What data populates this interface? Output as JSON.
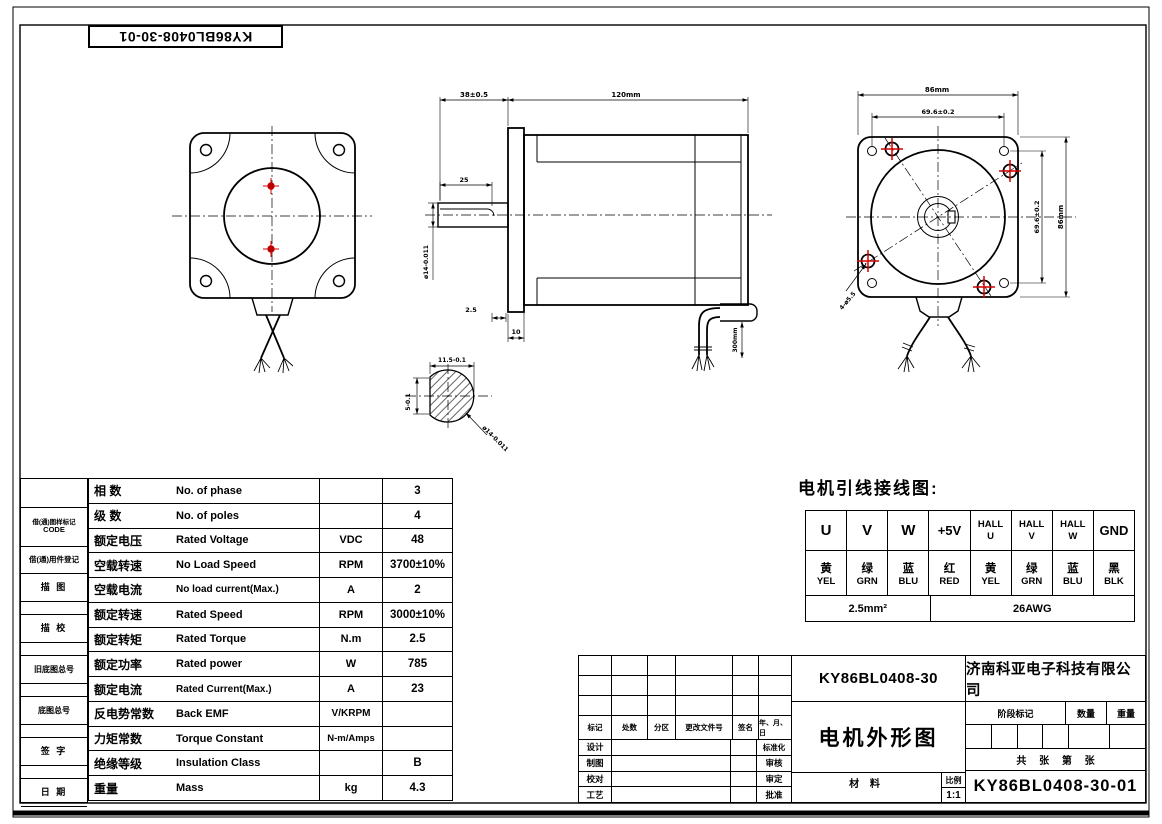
{
  "sheet": {
    "part_no_box": "KY86BL0408-30-01"
  },
  "left_strip": {
    "b1a": "借(通)图样标记",
    "b1b": "CODE",
    "b2": "借(通)用件登记",
    "b3": "描 图",
    "b4": "描 校",
    "b5": "旧底图总号",
    "b6": "底图总号",
    "b7": "签 字",
    "b8": "日 期"
  },
  "spec": {
    "rows": [
      {
        "cn": "相 数",
        "en": "No. of phase",
        "unit": "",
        "value": "3"
      },
      {
        "cn": "级 数",
        "en": "No. of poles",
        "unit": "",
        "value": "4"
      },
      {
        "cn": "额定电压",
        "en": "Rated Voltage",
        "unit": "VDC",
        "value": "48"
      },
      {
        "cn": "空载转速",
        "en": "No Load Speed",
        "unit": "RPM",
        "value": "3700±10%"
      },
      {
        "cn": "空载电流",
        "en": "No load current(Max.)",
        "unit": "A",
        "value": "2"
      },
      {
        "cn": "额定转速",
        "en": "Rated Speed",
        "unit": "RPM",
        "value": "3000±10%"
      },
      {
        "cn": "额定转矩",
        "en": "Rated Torque",
        "unit": "N.m",
        "value": "2.5"
      },
      {
        "cn": "额定功率",
        "en": "Rated power",
        "unit": "W",
        "value": "785"
      },
      {
        "cn": "额定电流",
        "en": "Rated Current(Max.)",
        "unit": "A",
        "value": "23"
      },
      {
        "cn": "反电势常数",
        "en": "Back EMF",
        "unit": "V/KRPM",
        "value": ""
      },
      {
        "cn": "力矩常数",
        "en": "Torque Constant",
        "unit": "N-m/Amps",
        "value": ""
      },
      {
        "cn": "绝缘等级",
        "en": "Insulation Class",
        "unit": "",
        "value": "B"
      },
      {
        "cn": "重量",
        "en": "Mass",
        "unit": "kg",
        "value": "4.3"
      }
    ]
  },
  "wiring": {
    "title": "电机引线接线图:",
    "pins": [
      "U",
      "V",
      "W",
      "+5V"
    ],
    "halls": [
      [
        "HALL",
        "U"
      ],
      [
        "HALL",
        "V"
      ],
      [
        "HALL",
        "W"
      ]
    ],
    "gnd": "GND",
    "colors_cn": [
      "黄",
      "绿",
      "蓝",
      "红",
      "黄",
      "绿",
      "蓝",
      "黑"
    ],
    "colors_en": [
      "YEL",
      "GRN",
      "BLU",
      "RED",
      "YEL",
      "GRN",
      "BLU",
      "BLK"
    ],
    "gauge_uvw": "2.5mm²",
    "gauge_rest": "26AWG"
  },
  "title_block": {
    "part_no": "KY86BL0408-30",
    "company": "济南科亚电子科技有限公司",
    "drawing_name": "电机外形图",
    "rev_headers": [
      "标记",
      "处数",
      "分区",
      "更改文件号",
      "签名",
      "年、月、日"
    ],
    "left_labels": [
      "设计",
      "制图",
      "校对",
      "工艺"
    ],
    "right_labels": [
      "标准化",
      "审核",
      "审定",
      "批准"
    ],
    "stage_mark": "阶段标记",
    "qty": "数量",
    "weight": "重量",
    "sheets": "共 张 第 张",
    "material": "材 料",
    "scale_label": "比例",
    "scale_value": "1:1",
    "drawing_no": "KY86BL0408-30-01"
  },
  "dims": {
    "side_front": "38±0.5",
    "side_body": "120mm",
    "shaft_flat": "25",
    "shaft_dia": "ø14-0.011",
    "flange_step": "2.5",
    "flange_thick": "10",
    "wire_len": "300mm",
    "sec_width": "11.5-0.1",
    "sec_flat": "5-0.1",
    "sec_dia": "ø14-0.011",
    "rear_outer_top": "86mm",
    "rear_holes_top": "69.6±0.2",
    "rear_holes_right": "69.6±0.2",
    "rear_outer_right": "86mm",
    "rear_hole_callout": "4-ø5.5"
  },
  "colors": {
    "accent_red": "#d40000"
  }
}
